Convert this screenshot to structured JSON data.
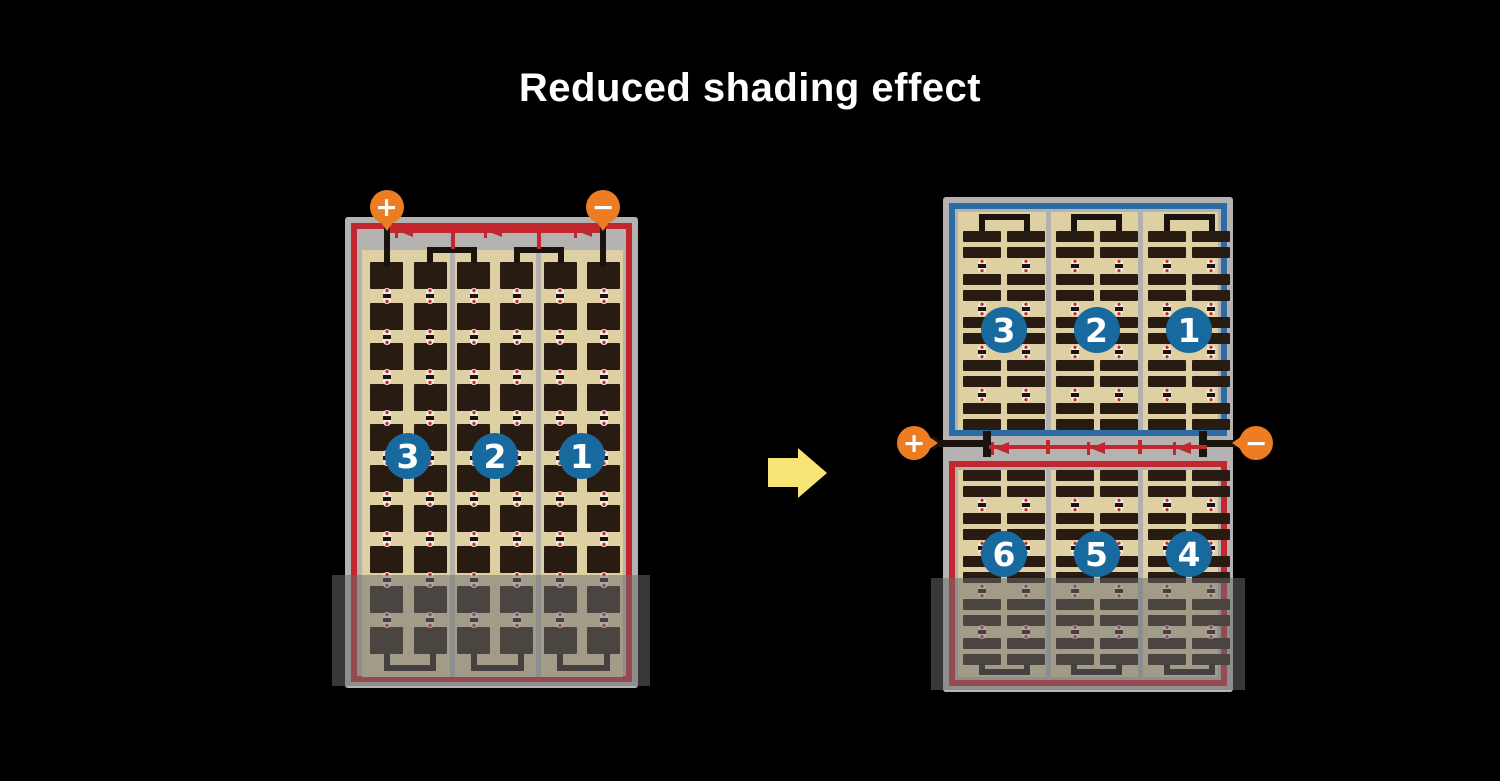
{
  "title": "Reduced shading effect",
  "modules": {
    "left": {
      "badges": [
        "3",
        "2",
        "1"
      ]
    },
    "right_top": {
      "badges": [
        "3",
        "2",
        "1"
      ]
    },
    "right_bottom": {
      "badges": [
        "6",
        "5",
        "4"
      ]
    }
  },
  "terminals": {
    "left_positive": "+",
    "left_negative": "−",
    "right_positive": "+",
    "right_negative": "−"
  },
  "icons": {
    "flow_arrow": "arrow-right-icon",
    "diode": "diode-left-icon",
    "positive_terminal": "plus-circle-icon",
    "negative_terminal": "minus-circle-icon"
  },
  "colors": {
    "background": "#000000",
    "frame": "#b5b3b1",
    "panel": "#ded0a2",
    "cell": "#281c12",
    "red_border": "#c1272d",
    "blue_border": "#2c6ba4",
    "badge_blue": "#17699e",
    "terminal_orange": "#ed7d23",
    "arrow_yellow": "#f8e474",
    "wire_dark": "#1a130e",
    "shade_gray": "#6c6c70"
  }
}
